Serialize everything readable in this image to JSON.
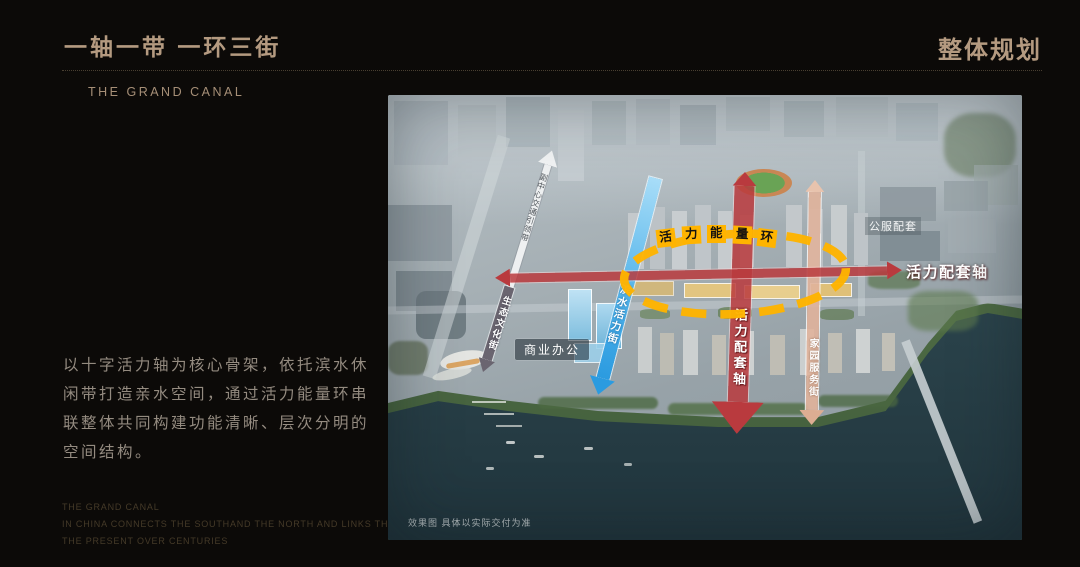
{
  "slide": {
    "title": "一轴一带 一环三街",
    "subtitle_en": "THE GRAND CANAL",
    "corner_title": "整体规划",
    "description": "以十字活力轴为核心骨架，依托滨水休闲带打造亲水空间，通过活力能量环串联整体共同构建功能清晰、层次分明的空间结构。",
    "footer_lines": [
      "THE GRAND CANAL",
      "IN CHINA CONNECTS THE SOUTHAND THE NORTH AND LINKS THE PAST AND",
      "THE PRESENT OVER CENTURIES"
    ]
  },
  "map": {
    "energy_ring": "活力能量环",
    "ring_chars": [
      "活",
      "力",
      "能",
      "量",
      "环"
    ],
    "labels": {
      "axis_horizontal": "活力配套轴",
      "axis_vertical": "活力配套轴",
      "transit_belt": "副中心交通引领带",
      "eco_culture_street": "生态文化街",
      "waterfront_vitality_street": "滨水活力街",
      "home_service_street": "家园服务街",
      "commercial_office": "商业办公",
      "public_service": "公服配套",
      "disclaimer": "效果图 具体以实际交付为准"
    },
    "colors": {
      "background": "#0c0a08",
      "accent_gold": "#b49a80",
      "ring_yellow": "#ffb400",
      "axis_red": "#b93a3e",
      "street_blue": "#2b9be0",
      "street_tan": "#ddad92",
      "street_gray": "#6a6570"
    }
  }
}
